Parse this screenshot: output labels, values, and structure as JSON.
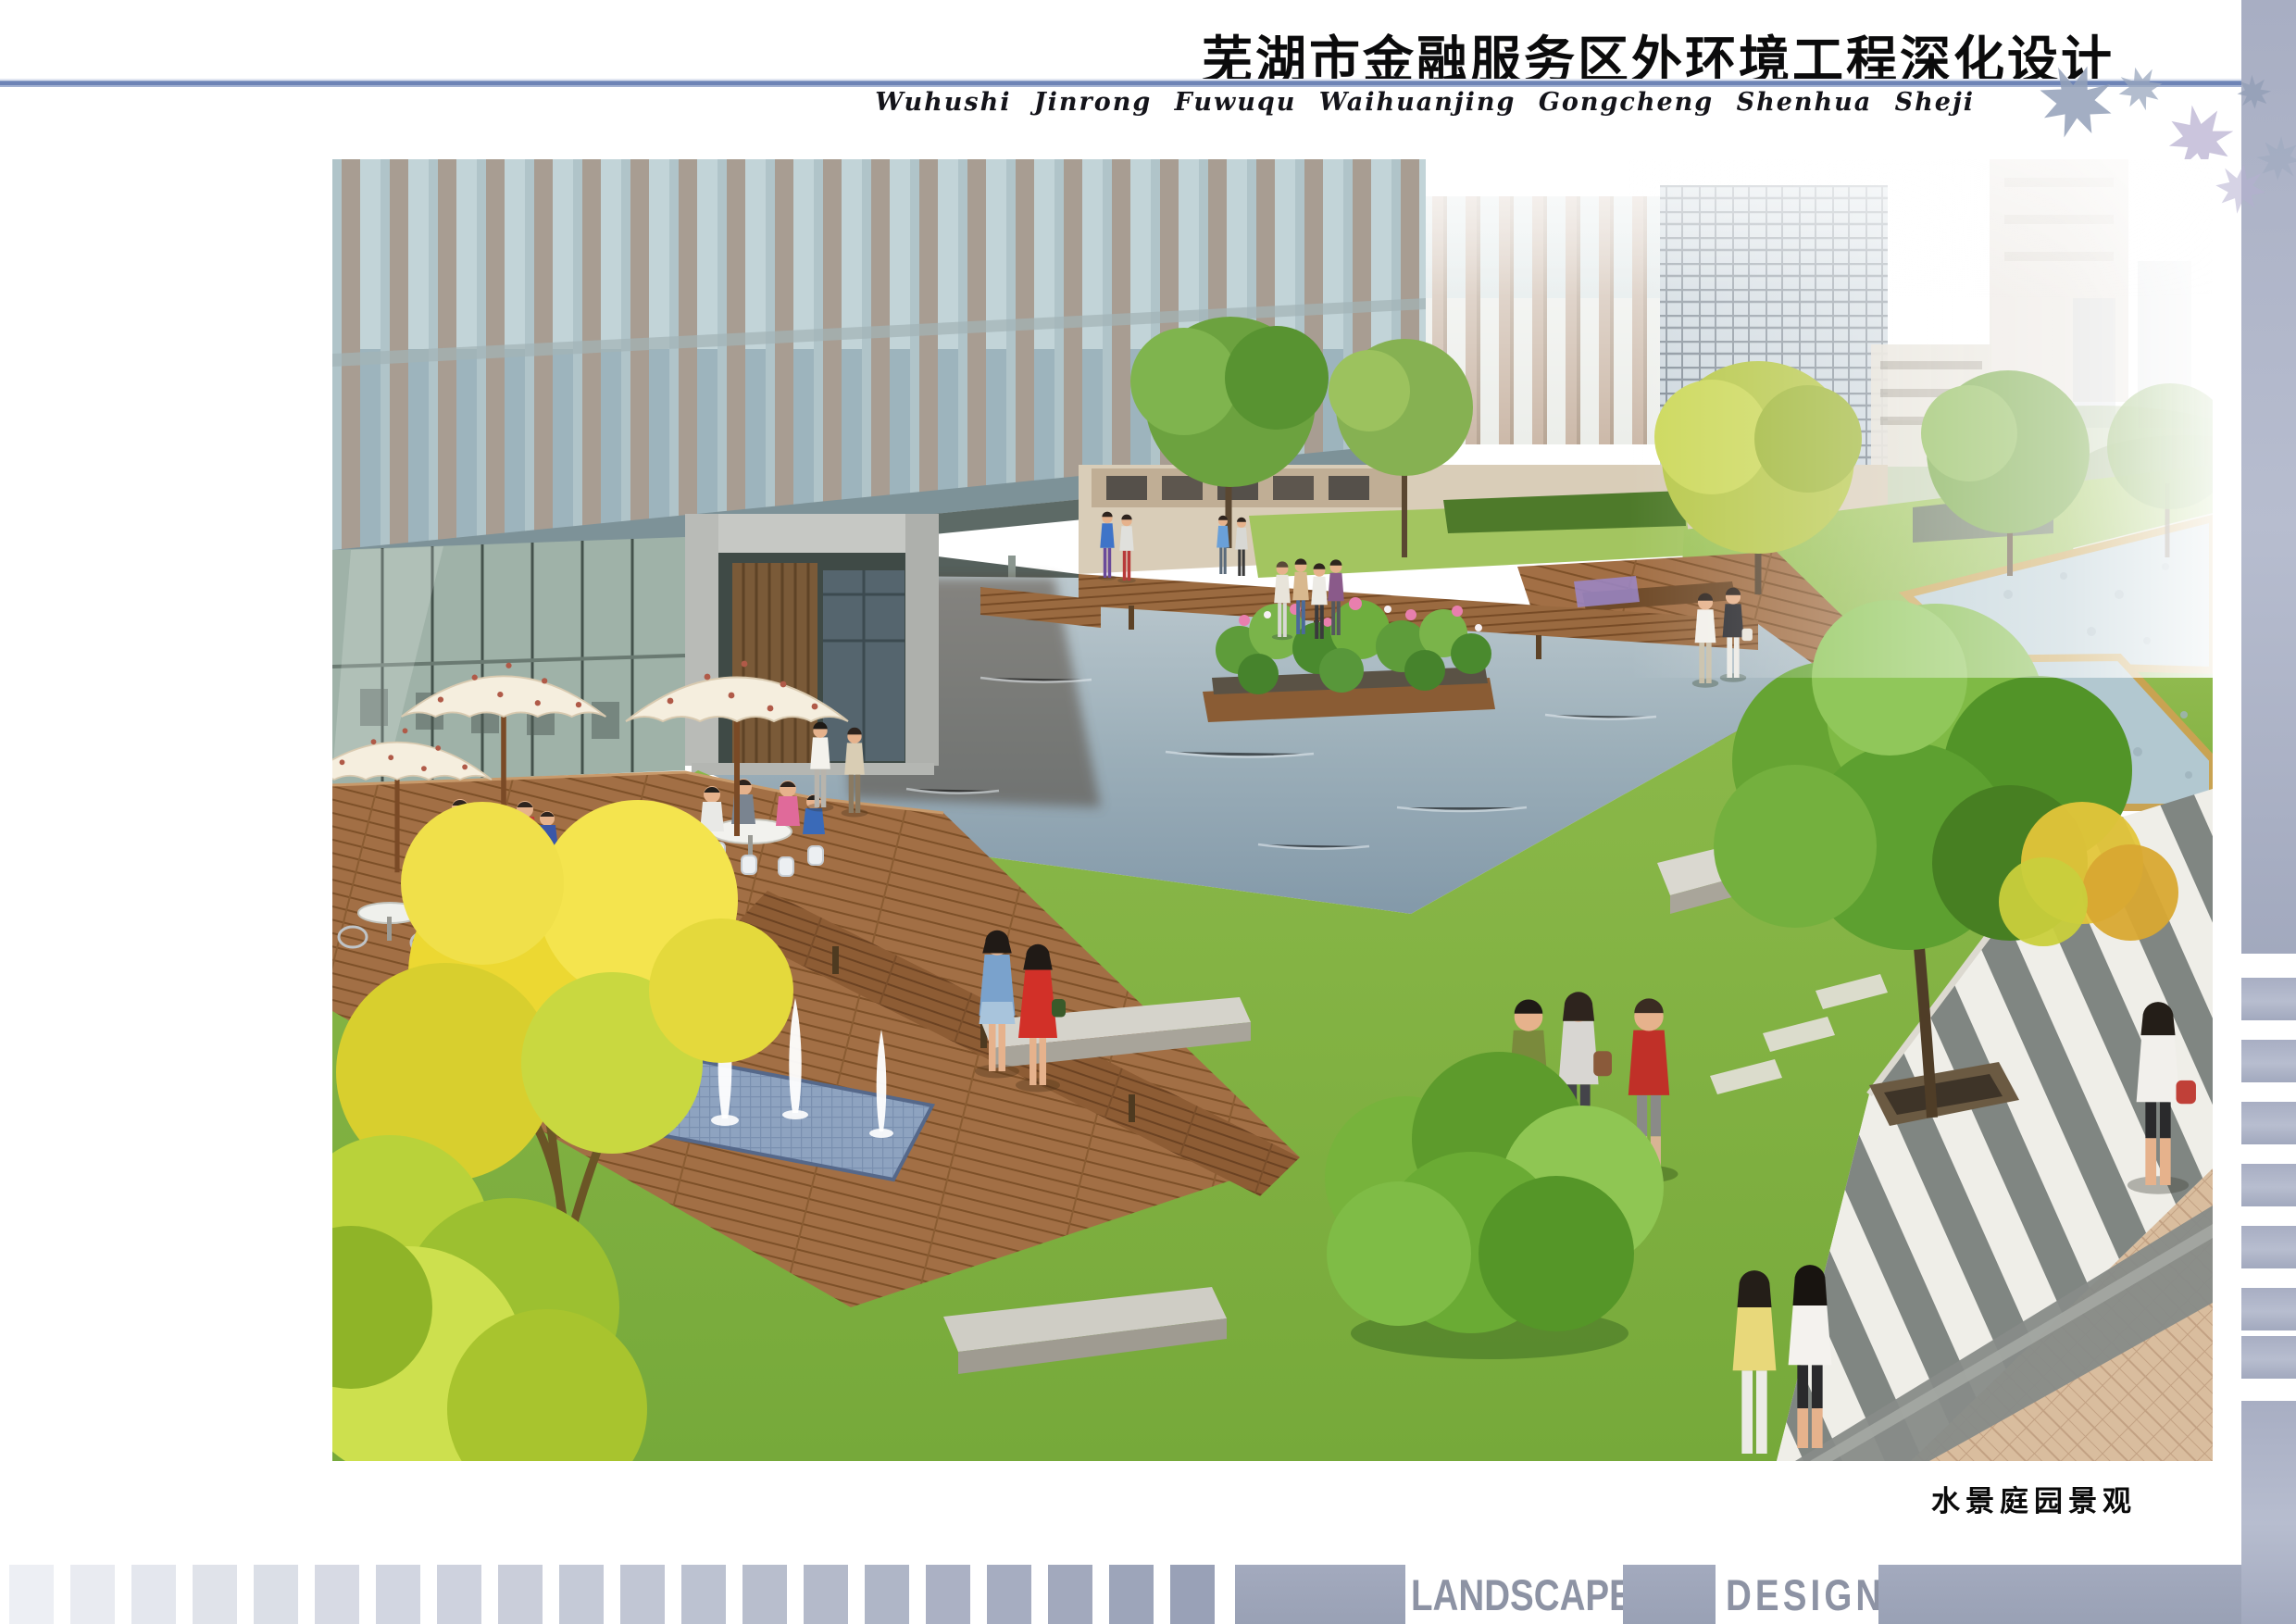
{
  "header": {
    "title": "芜湖市金融服务区外环境工程深化设计",
    "subtitle_pinyin": "Wuhushi  Jinrong  Fuwuqu  Waihuanjing  Gongcheng  Shenhua  Sheji"
  },
  "figure": {
    "caption": "水景庭园景观"
  },
  "footer": {
    "left_label": "LANDSCAPE",
    "right_label": "DESIGN",
    "squares": {
      "count": 20,
      "color_from": "#edeff4",
      "color_to": "#99a1b7"
    }
  },
  "palette": {
    "rule_blue": "#6e84b6",
    "sidebar_gray": "#a9afc3",
    "footer_block_gray": "#99a1b5",
    "footer_text_gray": "#8d93a4",
    "title_black": "#0b0b0c",
    "caption_black": "#0a0a0a"
  }
}
